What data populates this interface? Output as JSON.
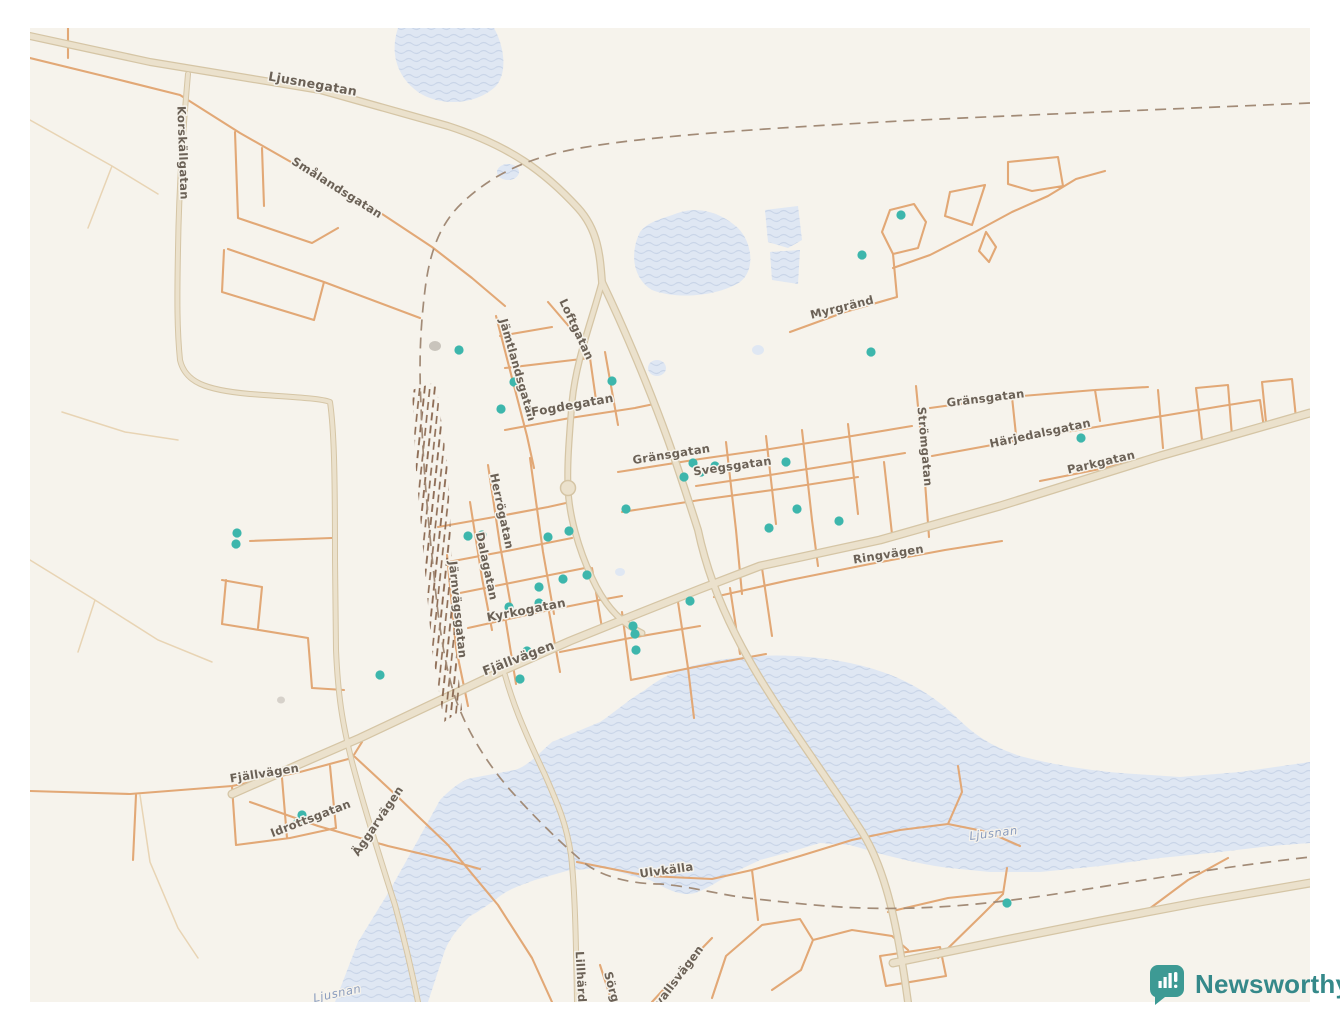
{
  "map": {
    "type": "street-map",
    "town": "Sveg",
    "colors": {
      "background": "#f6f3ec",
      "water": "#dfe7f3",
      "water_wave": "#c9d5e8",
      "road_major_fill": "#ebe1cc",
      "road_major_edge": "#d5c5a5",
      "road_minor": "#e2a876",
      "boundary_dash": "#a28b77",
      "marker": "#3db6ac",
      "road_label": "#6b6156",
      "water_label": "#8a9cbe"
    },
    "road_labels": [
      {
        "t": "Ljusnegatan",
        "x": 312,
        "y": 88,
        "r": 10,
        "s": 12.5
      },
      {
        "t": "Korskällgatan",
        "x": 179,
        "y": 153,
        "r": 88
      },
      {
        "t": "Smålandsgatan",
        "x": 335,
        "y": 191,
        "r": 32
      },
      {
        "t": "Jämtlandsgatan",
        "x": 514,
        "y": 371,
        "r": 74
      },
      {
        "t": "Loftgatan",
        "x": 573,
        "y": 331,
        "r": 65
      },
      {
        "t": "Fogdegatan",
        "x": 573,
        "y": 409,
        "r": -10,
        "s": 12
      },
      {
        "t": "Gränsgatan",
        "x": 672,
        "y": 458,
        "r": -9
      },
      {
        "t": "Svegsgatan",
        "x": 733,
        "y": 470,
        "r": -8
      },
      {
        "t": "Myrgränd",
        "x": 843,
        "y": 311,
        "r": -14
      },
      {
        "t": "Strömgatan",
        "x": 921,
        "y": 447,
        "r": 85
      },
      {
        "t": "Gränsgatan",
        "x": 986,
        "y": 402,
        "r": -7
      },
      {
        "t": "Härjedalsgatan",
        "x": 1041,
        "y": 437,
        "r": -12
      },
      {
        "t": "Parkgatan",
        "x": 1102,
        "y": 466,
        "r": -13
      },
      {
        "t": "Ringvägen",
        "x": 889,
        "y": 558,
        "r": -9
      },
      {
        "t": "Herrögatan",
        "x": 498,
        "y": 512,
        "r": 78
      },
      {
        "t": "Dalagatan",
        "x": 483,
        "y": 567,
        "r": 78
      },
      {
        "t": "Järnvägsgatan",
        "x": 454,
        "y": 610,
        "r": 84
      },
      {
        "t": "Kyrkogatan",
        "x": 527,
        "y": 614,
        "r": -11,
        "s": 12
      },
      {
        "t": "Fjällvägen",
        "x": 520,
        "y": 662,
        "r": -21,
        "s": 12.5
      },
      {
        "t": "Fjällvägen",
        "x": 265,
        "y": 777,
        "r": -9
      },
      {
        "t": "Idrottsgatan",
        "x": 312,
        "y": 822,
        "r": -21
      },
      {
        "t": "Äggarvägen",
        "x": 381,
        "y": 823,
        "r": -56
      },
      {
        "t": "Ulvkälla",
        "x": 667,
        "y": 874,
        "r": -8
      },
      {
        "t": "Lillhärd",
        "x": 577,
        "y": 977,
        "r": 87
      },
      {
        "t": "Sörg",
        "x": 608,
        "y": 988,
        "r": 75
      },
      {
        "t": "vallsvägen",
        "x": 682,
        "y": 978,
        "r": -53
      }
    ],
    "water_labels": [
      {
        "t": "Ljusnan",
        "x": 994,
        "y": 837,
        "r": -7
      },
      {
        "t": "Ljusnan",
        "x": 338,
        "y": 997,
        "r": -12
      }
    ],
    "data_points": [
      [
        459,
        350
      ],
      [
        514,
        382
      ],
      [
        612,
        381
      ],
      [
        501,
        409
      ],
      [
        901,
        215
      ],
      [
        862,
        255
      ],
      [
        871,
        352
      ],
      [
        1081,
        438
      ],
      [
        237,
        533
      ],
      [
        236,
        544
      ],
      [
        380,
        675
      ],
      [
        684,
        477
      ],
      [
        693,
        463
      ],
      [
        701,
        472
      ],
      [
        715,
        466
      ],
      [
        786,
        462
      ],
      [
        626,
        509
      ],
      [
        769,
        528
      ],
      [
        797,
        509
      ],
      [
        839,
        521
      ],
      [
        468,
        536
      ],
      [
        482,
        535
      ],
      [
        548,
        537
      ],
      [
        569,
        531
      ],
      [
        539,
        587
      ],
      [
        563,
        579
      ],
      [
        587,
        575
      ],
      [
        509,
        607
      ],
      [
        539,
        603
      ],
      [
        633,
        626
      ],
      [
        635,
        634
      ],
      [
        636,
        650
      ],
      [
        527,
        651
      ],
      [
        520,
        679
      ],
      [
        690,
        601
      ],
      [
        302,
        815
      ],
      [
        298,
        822
      ],
      [
        1007,
        903
      ]
    ]
  },
  "branding": {
    "name": "Newsworthy",
    "logo_icon": "bar-chart-speech-bubble",
    "color": "#35898a",
    "icon_color": "#3d9a94"
  }
}
